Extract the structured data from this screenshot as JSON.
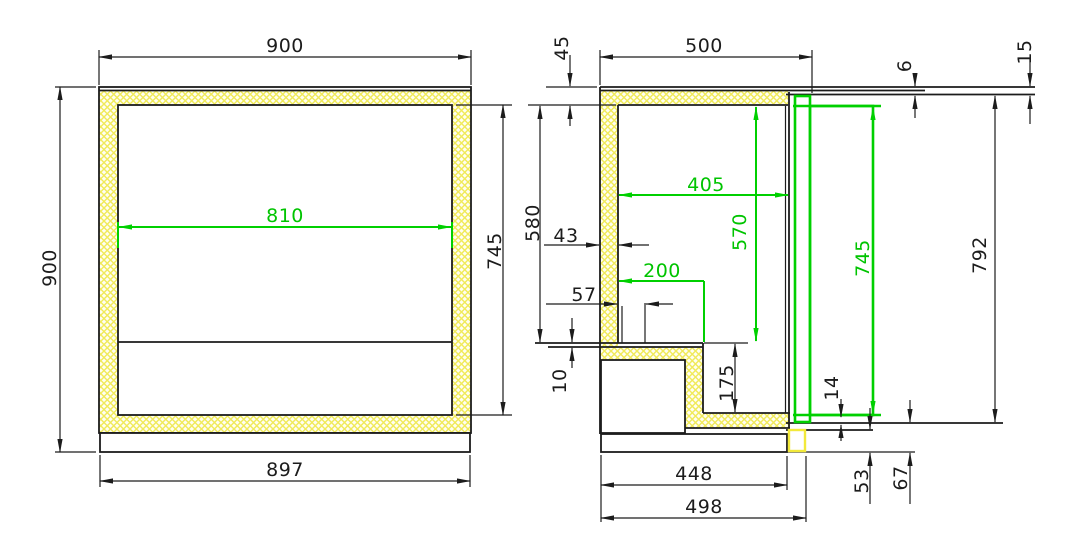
{
  "drawing": {
    "description": "CAD technical drawing - insulated refrigerated cabinet, front and side cross sections",
    "colors": {
      "background": "#ffffff",
      "line_black": "#1c1c1c",
      "dimension_green": "#00c400",
      "hatch_yellow": "#f0ea5a",
      "hatch_background": "#fffef2"
    },
    "front_section": {
      "dims": {
        "outer_width": "900",
        "outer_height": "900",
        "base_width": "897",
        "inner_width": "810",
        "inner_height": "745"
      }
    },
    "side_section": {
      "dims": {
        "top_thickness": "45",
        "top_depth": "500",
        "counter_lip": "6",
        "counter_thickness": "15",
        "upper_inner_height": "580",
        "wall_thickness": "43",
        "inner_offset": "57",
        "floor_plate": "10",
        "inner_depth": "405",
        "height_to_step": "570",
        "step_depth": "200",
        "door_height": "745",
        "rear_height": "792",
        "step_height": "175",
        "door_bottom_gap": "14",
        "base_depth": "448",
        "overall_depth": "498",
        "bottom_detail_53": "53",
        "bottom_detail_67": "67"
      }
    }
  }
}
